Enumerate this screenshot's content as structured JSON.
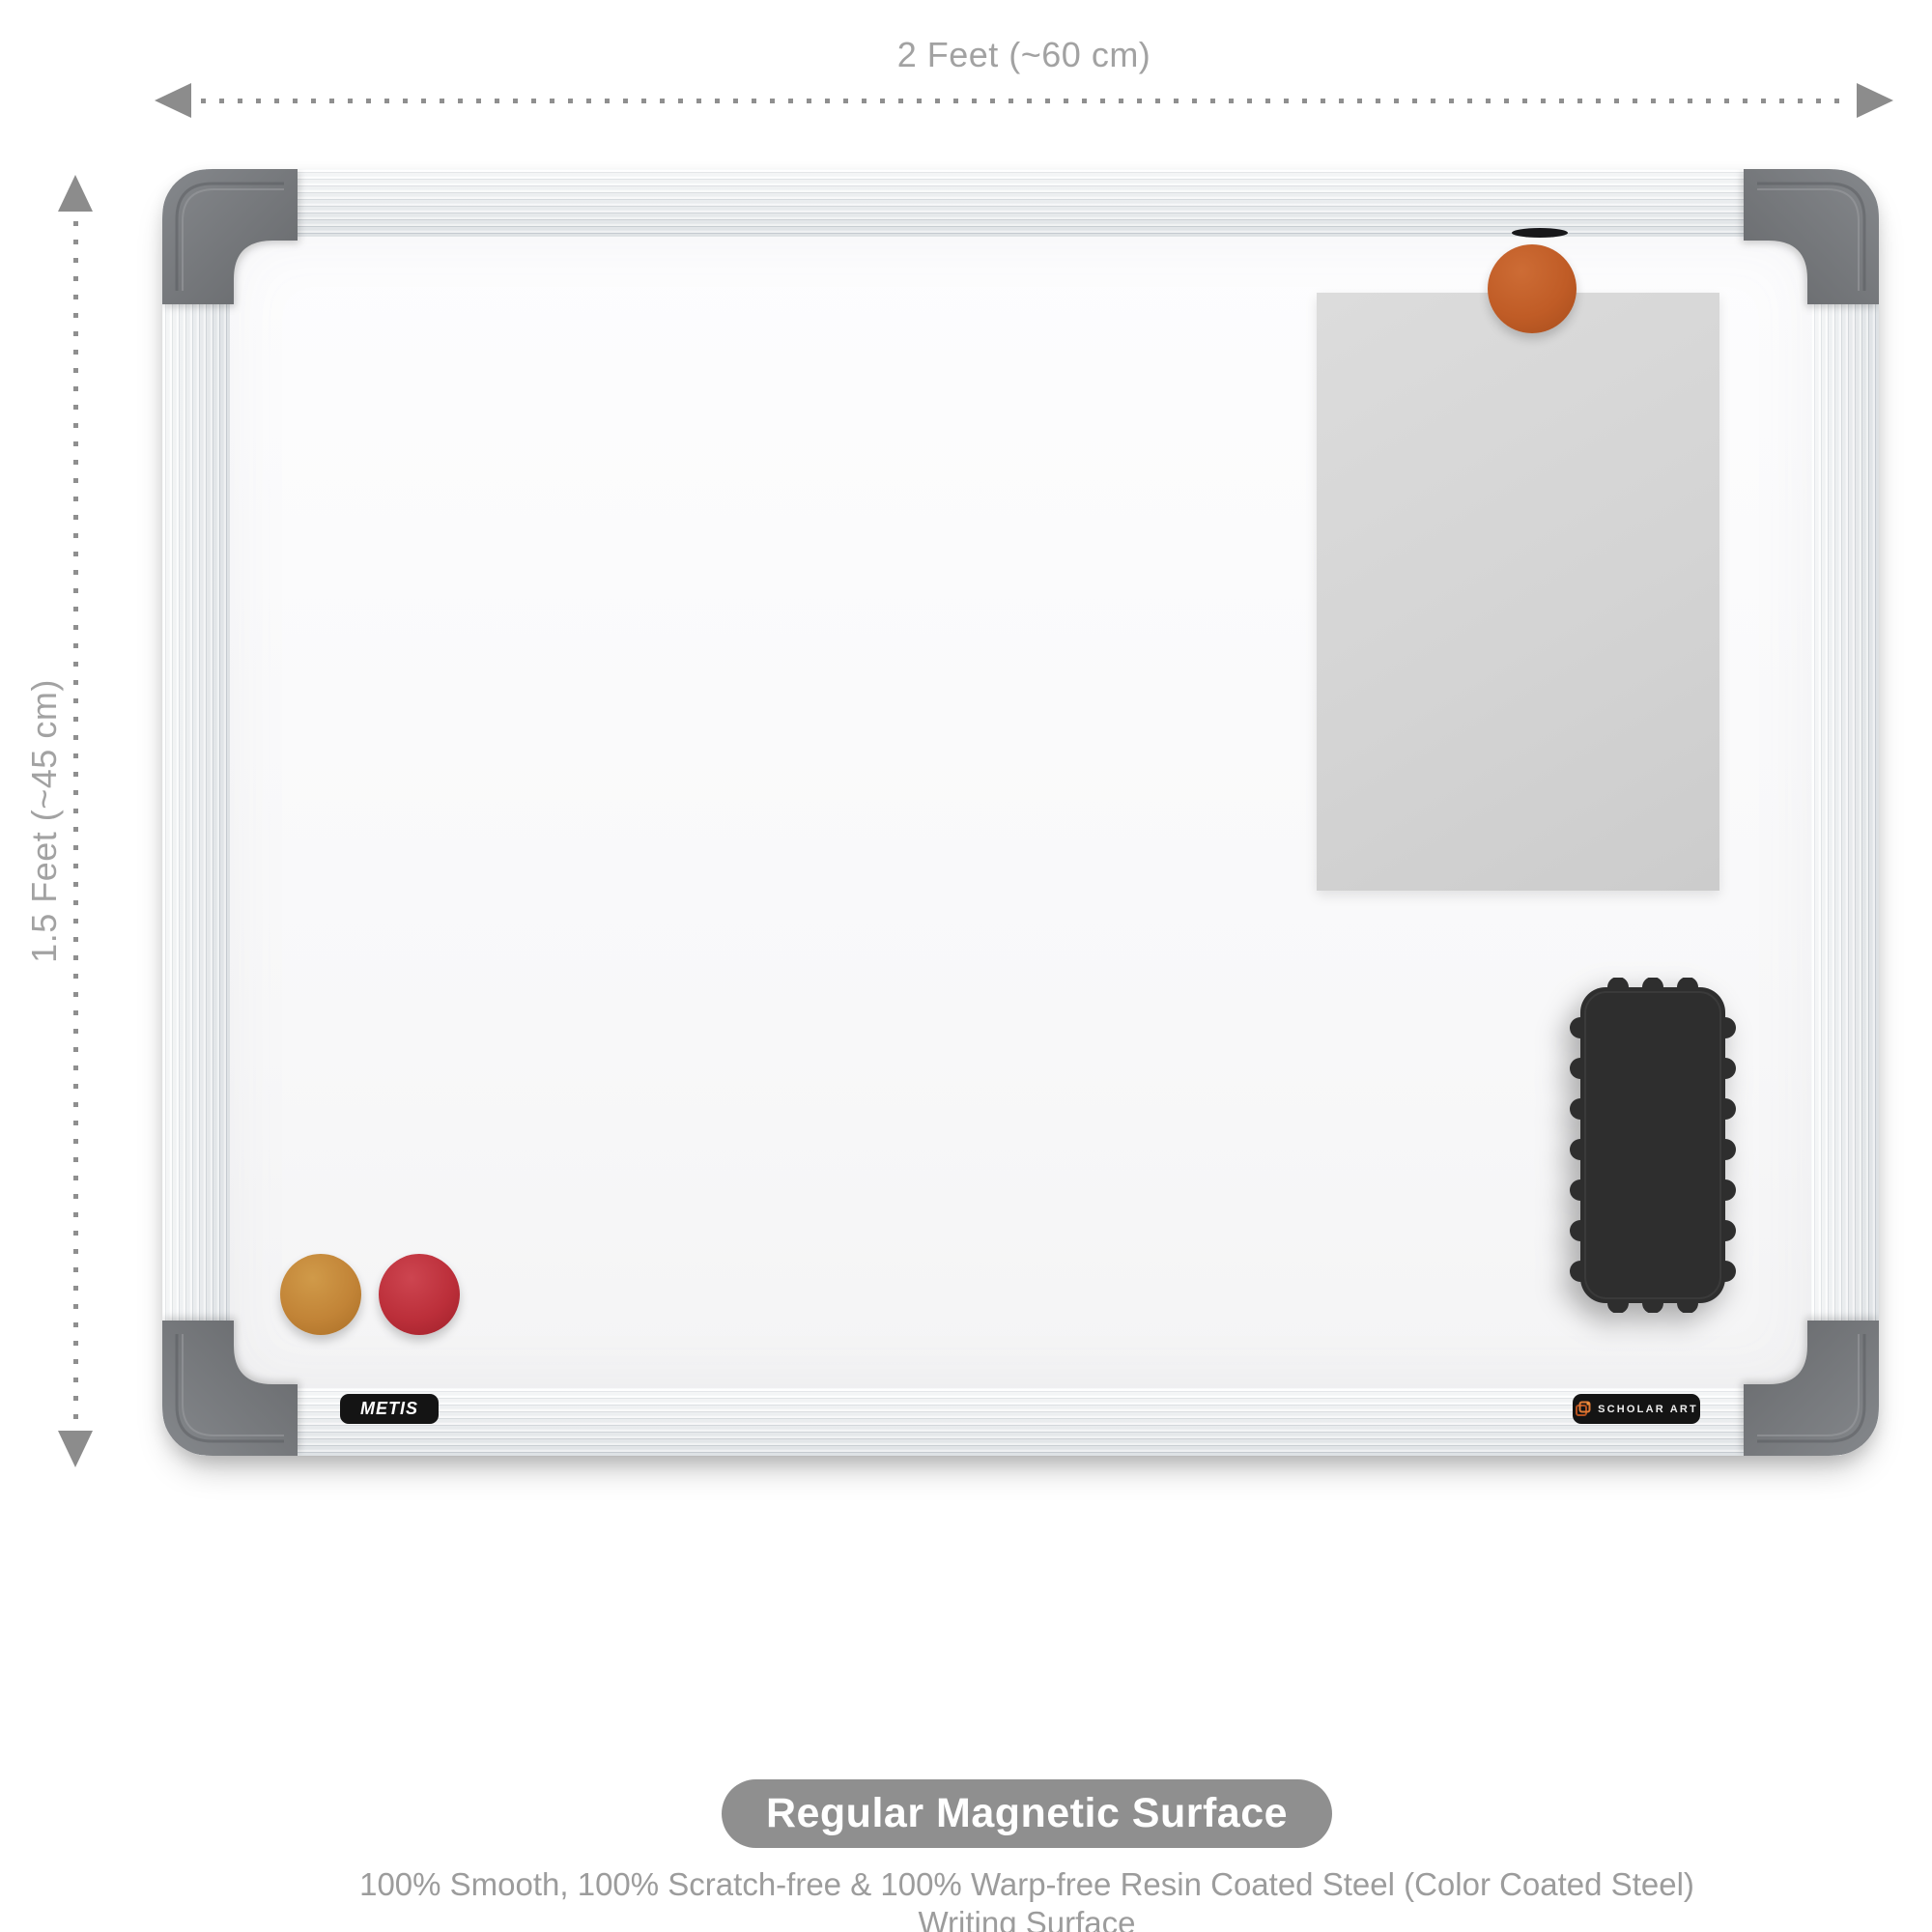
{
  "dimensions": {
    "width_label": "2 Feet (~60 cm)",
    "height_label": "1.5 Feet (~45 cm)"
  },
  "board": {
    "brand_label": "METIS",
    "maker_label": "SCHOLAR ART",
    "accessories": [
      "orange-magnet",
      "paper-sheet",
      "black-eraser",
      "amber-magnet",
      "red-magnet",
      "marker-hook"
    ]
  },
  "footer": {
    "badge_label": "Regular Magnetic Surface",
    "caption_line1": "100% Smooth, 100% Scratch-free & 100% Warp-free Resin Coated Steel (Color Coated Steel)",
    "caption_line2": "Writing Surface"
  },
  "colors": {
    "dimension_gray": "#a2a2a2",
    "badge_gray": "#8f8f8f",
    "corner_cap_gray": "#75787a",
    "frame_silver": "#e9ecef",
    "magnet_orange": "#c05c26",
    "magnet_amber": "#c28437",
    "magnet_red": "#bc2f3a",
    "eraser_black": "#2e2e2e",
    "label_black": "#141414",
    "logo_orange": "#d4622a",
    "paper_gray": "#d4d4d4"
  }
}
